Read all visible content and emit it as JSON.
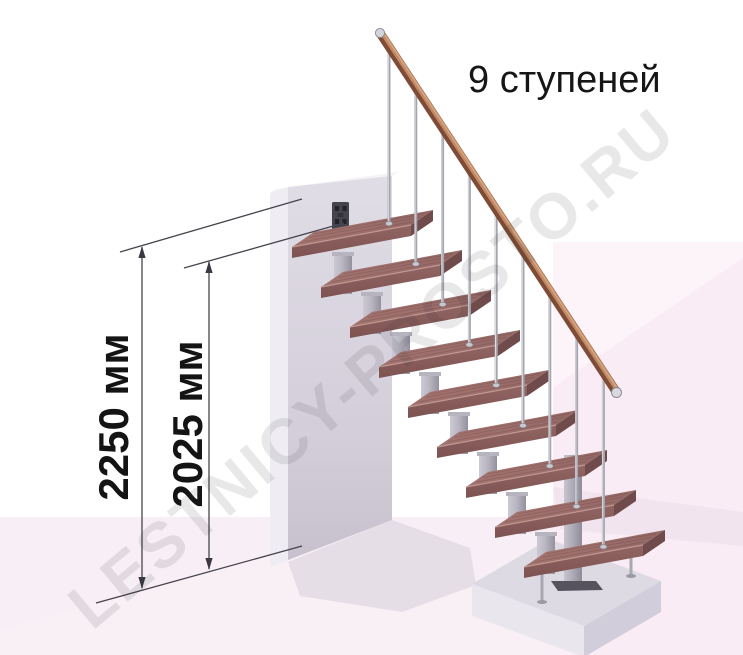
{
  "labels": {
    "steps_count_label": "9 ступеней",
    "dimension_total": "2250 мм",
    "dimension_upper": "2025 мм"
  },
  "watermark": "LESTNICY-PROSTO.RU",
  "diagram": {
    "type": "staircase-side-elevation",
    "steps_count": 9,
    "total_height_mm": 2250,
    "upper_height_mm": 2025,
    "colors": {
      "tread_top": "#9d6f6c",
      "tread_front": "#8a605e",
      "tread_side": "#6f4b4b",
      "tread_bevel": "#c59d97",
      "handrail": "#8a5138",
      "handrail_highlight": "#c08a68",
      "metal_baluster": "#a5a5af",
      "metal_strut_light": "#ccc9d3",
      "metal_strut_dark": "#94919e",
      "wall": "#d6d2dd",
      "platform": "#dedae4",
      "floor_pink": "#f7eff5",
      "background_pink": "#faecf4",
      "dimension_line": "#3c3a42",
      "text": "#141414"
    }
  }
}
